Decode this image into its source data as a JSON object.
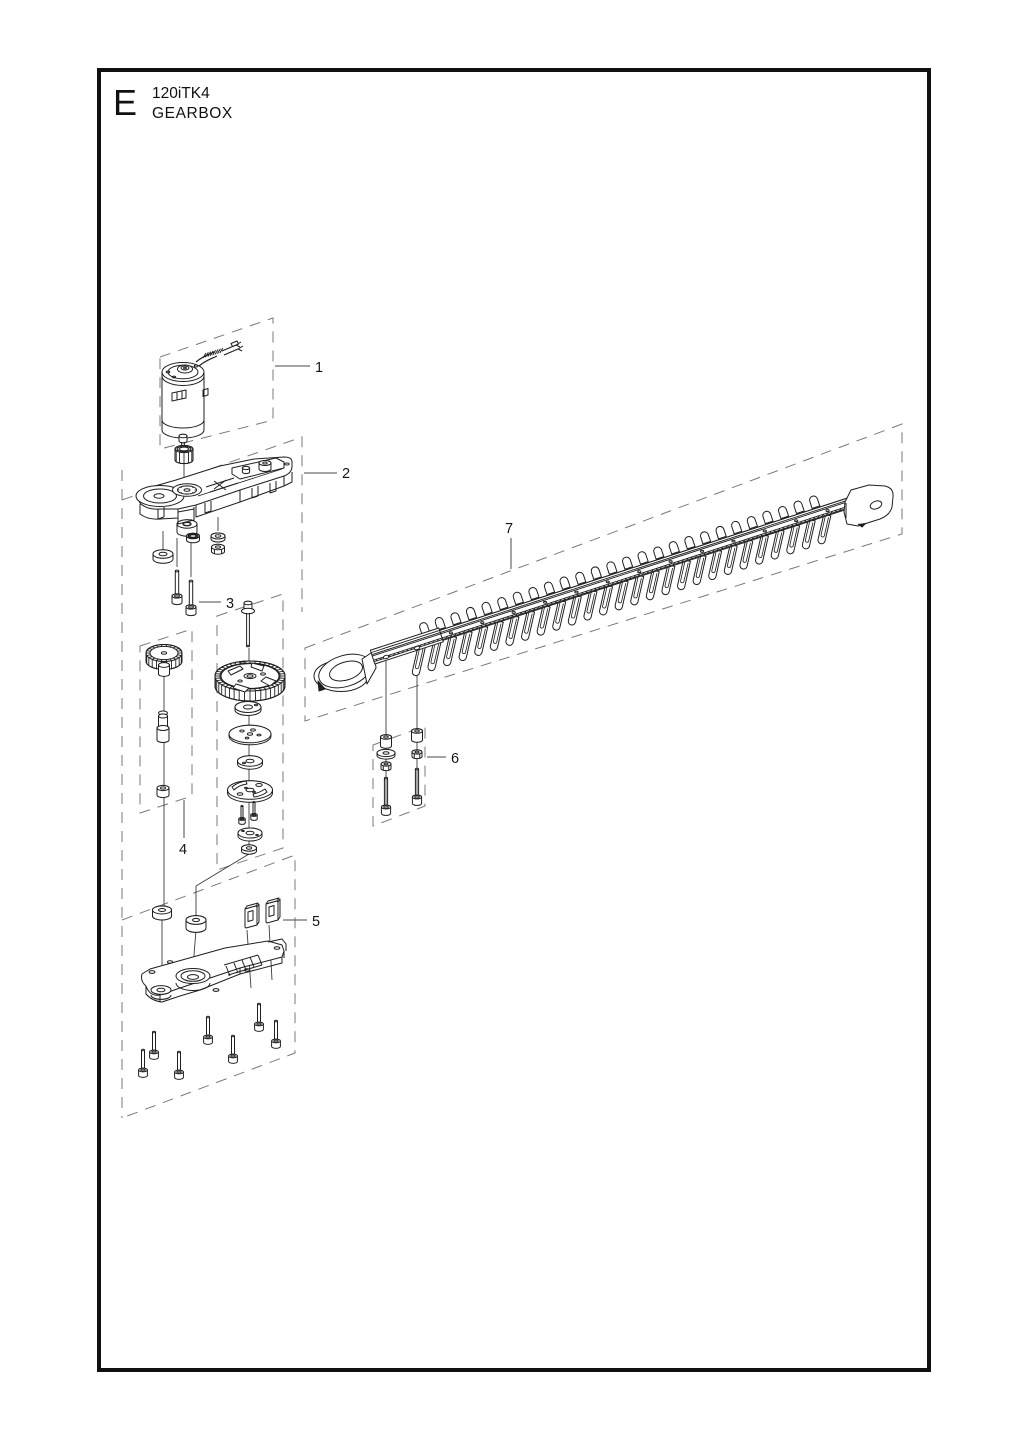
{
  "header": {
    "section_letter": "E",
    "model": "120iTK4",
    "title": "GEARBOX"
  },
  "callouts": [
    {
      "num": "1"
    },
    {
      "num": "2"
    },
    {
      "num": "3"
    },
    {
      "num": "4"
    },
    {
      "num": "5"
    },
    {
      "num": "6"
    },
    {
      "num": "7"
    }
  ],
  "colors": {
    "ink": "#1f1f1f",
    "dash": "#7a7a7a",
    "leader": "#4a4a4a",
    "paper": "#ffffff"
  }
}
